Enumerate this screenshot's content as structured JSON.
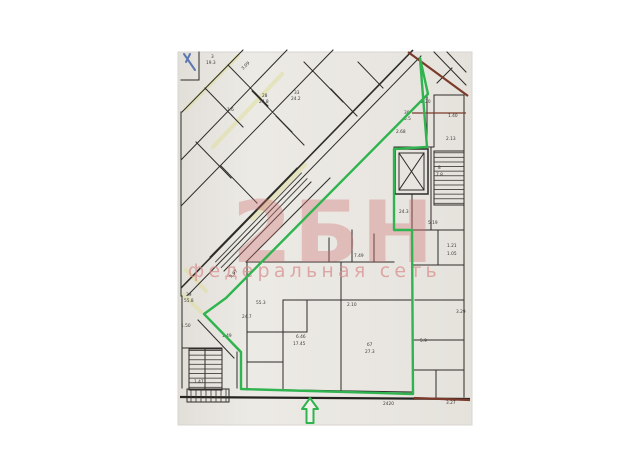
{
  "scan": {
    "description": "scanned floor plan page",
    "paper_color": "#e9e6e1"
  },
  "watermark": {
    "logo": "2БН",
    "tagline": "федеральная сеть",
    "color": "#d88e8e"
  },
  "selection": {
    "outline_color": "#2fb44f",
    "arrow": "up-arrow-entrance"
  },
  "plan": {
    "street_line_color": "#7c3a2b",
    "highlight_color": "#dfdf9d",
    "blue_mark_color": "#4565a8",
    "labels": [
      {
        "text": "3",
        "x": 211,
        "y": 58
      },
      {
        "text": "19.3",
        "x": 206,
        "y": 64
      },
      {
        "text": "28",
        "x": 262,
        "y": 97
      },
      {
        "text": "24.8",
        "x": 259,
        "y": 103
      },
      {
        "text": "33",
        "x": 294,
        "y": 94
      },
      {
        "text": "24.2",
        "x": 291,
        "y": 100
      },
      {
        "text": "1.6",
        "x": 227,
        "y": 111
      },
      {
        "text": "3.09",
        "x": 243,
        "y": 70,
        "rot": -45
      },
      {
        "text": "29",
        "x": 186,
        "y": 296
      },
      {
        "text": "55.8",
        "x": 184,
        "y": 302
      },
      {
        "text": "30",
        "x": 404,
        "y": 114
      },
      {
        "text": "5.5",
        "x": 404,
        "y": 120
      },
      {
        "text": "2.20",
        "x": 421,
        "y": 103
      },
      {
        "text": "1.40",
        "x": 448,
        "y": 117
      },
      {
        "text": "2.13",
        "x": 446,
        "y": 140
      },
      {
        "text": "2.68",
        "x": 396,
        "y": 133
      },
      {
        "text": "7.49",
        "x": 354,
        "y": 257
      },
      {
        "text": "24.3",
        "x": 399,
        "y": 213
      },
      {
        "text": "8",
        "x": 438,
        "y": 169
      },
      {
        "text": "7.8",
        "x": 436,
        "y": 176
      },
      {
        "text": "5.19",
        "x": 428,
        "y": 224
      },
      {
        "text": "1.21",
        "x": 447,
        "y": 247
      },
      {
        "text": "1.05",
        "x": 447,
        "y": 255
      },
      {
        "text": "3.29",
        "x": 456,
        "y": 313
      },
      {
        "text": "2.10",
        "x": 347,
        "y": 306
      },
      {
        "text": "б7",
        "x": 367,
        "y": 346
      },
      {
        "text": "27.3",
        "x": 365,
        "y": 353
      },
      {
        "text": "5.9",
        "x": 420,
        "y": 342
      },
      {
        "text": "6.46",
        "x": 296,
        "y": 338
      },
      {
        "text": "17.45",
        "x": 293,
        "y": 345
      },
      {
        "text": "24.7",
        "x": 242,
        "y": 318
      },
      {
        "text": "55.3",
        "x": 256,
        "y": 304
      },
      {
        "text": "5.97",
        "x": 231,
        "y": 278,
        "rot": -45
      },
      {
        "text": "1.49",
        "x": 222,
        "y": 337
      },
      {
        "text": "1.47",
        "x": 194,
        "y": 383
      },
      {
        "text": "1.50",
        "x": 181,
        "y": 327
      },
      {
        "text": "2420",
        "x": 383,
        "y": 405
      },
      {
        "text": "3.27",
        "x": 446,
        "y": 404
      }
    ]
  }
}
